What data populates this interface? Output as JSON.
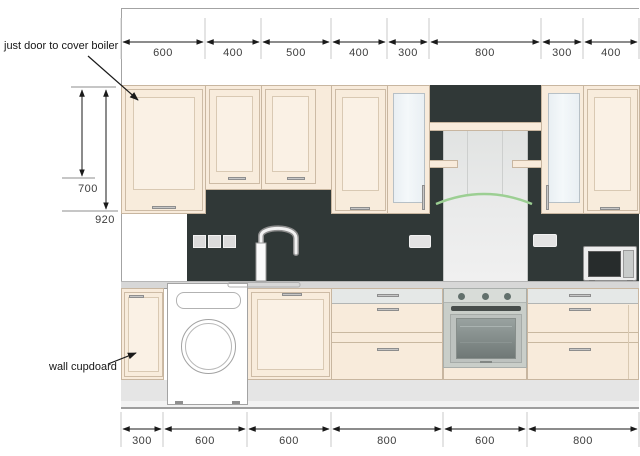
{
  "annotations": {
    "boiler_note": "just door to cover boiler",
    "wall_cupboard_note": "wall cupdoard"
  },
  "dimensions": {
    "top": [
      "600",
      "400",
      "500",
      "400",
      "300",
      "800",
      "300",
      "400"
    ],
    "bottom": [
      "300",
      "600",
      "600",
      "800",
      "600",
      "800"
    ],
    "left": [
      "700",
      "920"
    ]
  },
  "fixtures": {
    "appliances": [
      "washing-machine",
      "built-in-oven",
      "cooker-hood",
      "microwave"
    ],
    "fittings": [
      "mixer-tap",
      "sink",
      "light-switches",
      "power-sockets",
      "glass-door-cabinets",
      "wall-cabinets",
      "base-cabinets",
      "drawer-units",
      "plinth",
      "worktop"
    ]
  },
  "colors": {
    "cabinet_cream": "#f8ebdb",
    "splashback_dark": "#303837",
    "worktop_grey": "#d7d7d7",
    "hood_steel": "#e4e6e5",
    "visor_green": "#9ccf93",
    "oven_steel": "#c9cec9"
  }
}
